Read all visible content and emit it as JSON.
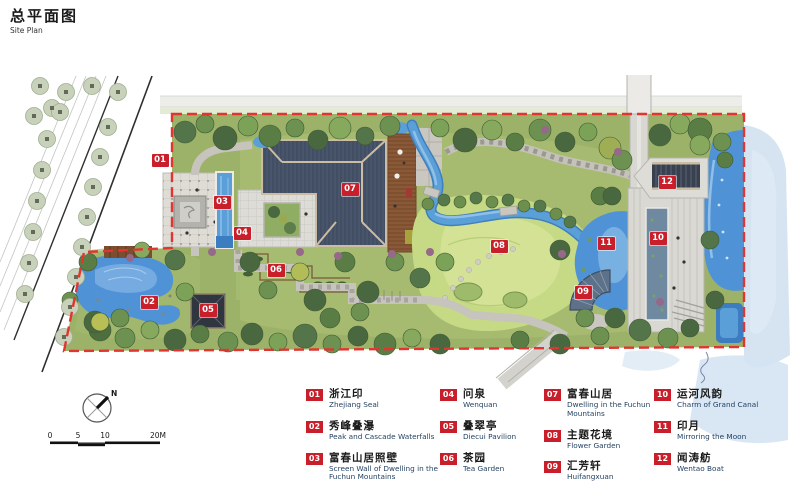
{
  "page": {
    "title": "总平面图",
    "subtitle": "Site Plan"
  },
  "compass": {
    "north_label": "N"
  },
  "scale_bar": {
    "labels": [
      "0",
      "5",
      "10",
      "20M"
    ]
  },
  "colors": {
    "accent_red": "#c81f2a",
    "boundary_red": "#e23531",
    "water_blue": "#4f93d6",
    "lawn_green": "#c6d985",
    "roof_slate": "#49556b",
    "legend_en_blue": "#1e3d5f"
  },
  "plan_markers": [
    {
      "num": "01",
      "x": 160,
      "y": 160
    },
    {
      "num": "02",
      "x": 149,
      "y": 302
    },
    {
      "num": "03",
      "x": 222,
      "y": 202
    },
    {
      "num": "04",
      "x": 242,
      "y": 233
    },
    {
      "num": "05",
      "x": 208,
      "y": 310
    },
    {
      "num": "06",
      "x": 276,
      "y": 270
    },
    {
      "num": "07",
      "x": 350,
      "y": 189
    },
    {
      "num": "08",
      "x": 499,
      "y": 246
    },
    {
      "num": "09",
      "x": 583,
      "y": 292
    },
    {
      "num": "10",
      "x": 658,
      "y": 238
    },
    {
      "num": "11",
      "x": 606,
      "y": 243
    },
    {
      "num": "12",
      "x": 667,
      "y": 182
    }
  ],
  "legend": {
    "items": [
      {
        "num": "01",
        "zh": "浙江印",
        "en": "Zhejiang Seal"
      },
      {
        "num": "02",
        "zh": "秀峰叠瀑",
        "en": "Peak and Cascade Waterfalls"
      },
      {
        "num": "03",
        "zh": "富春山居照壁",
        "en": "Screen Wall of Dwelling in the Fuchun Mountains"
      },
      {
        "num": "04",
        "zh": "问泉",
        "en": "Wenquan"
      },
      {
        "num": "05",
        "zh": "叠翠亭",
        "en": "Diecui Pavilion"
      },
      {
        "num": "06",
        "zh": "茶园",
        "en": "Tea Garden"
      },
      {
        "num": "07",
        "zh": "富春山居",
        "en": "Dwelling in the Fuchun Mountains"
      },
      {
        "num": "08",
        "zh": "主题花境",
        "en": "Flower Garden"
      },
      {
        "num": "09",
        "zh": "汇芳轩",
        "en": "Huifangxuan"
      },
      {
        "num": "10",
        "zh": "运河风韵",
        "en": "Charm of Grand Canal"
      },
      {
        "num": "11",
        "zh": "印月",
        "en": "Mirroring the Moon"
      },
      {
        "num": "12",
        "zh": "闻涛舫",
        "en": "Wentao Boat"
      }
    ]
  }
}
